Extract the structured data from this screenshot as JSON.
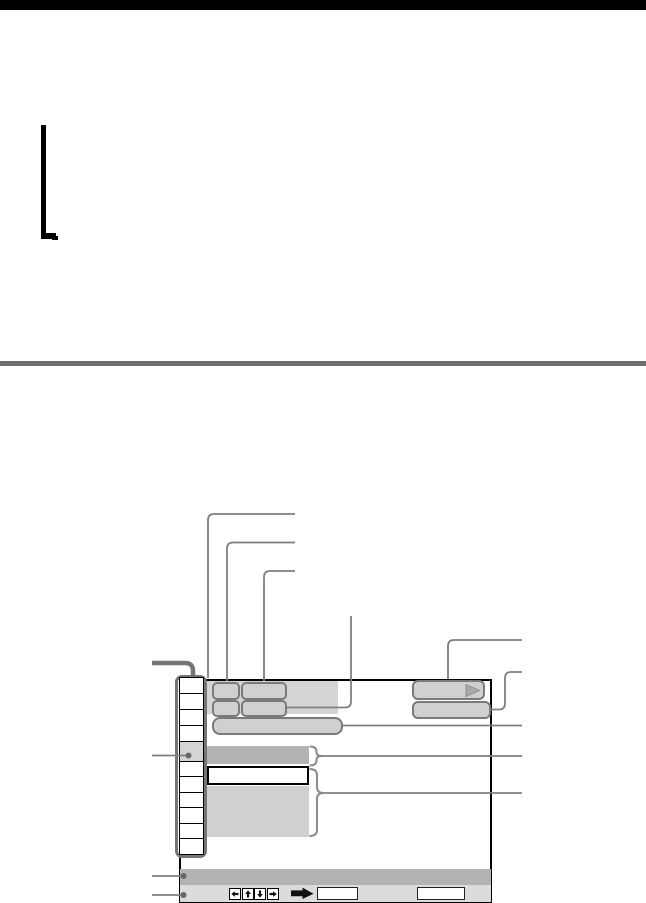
{
  "palette": {
    "top_rule": "#000000",
    "divider": "#6e6e6e",
    "callout_line": "#7f7f7f",
    "thick_leader": "#757575",
    "panel_gray": "#d4d4d4",
    "button_gray": "#d0d0d0",
    "button_border": "#7a7a7a",
    "selected_row_gray": "#b3b3b3",
    "detail_block_gray": "#d0d0d0",
    "bottom_bar_dark": "#b3b3b3",
    "bottom_bar_light": "#dcdcdc",
    "play_triangle": "#a9a9a9",
    "callout_dot": "#686868",
    "screen_border": "#000000"
  },
  "diagram": {
    "index_column_cells": 11,
    "highlighted_cell_index": 5,
    "callout_dots": 3,
    "top_callout_lines": 4,
    "right_callout_lines": 5,
    "left_callout_lines": 4,
    "icons": [
      "play-icon",
      "left-arrow-icon",
      "up-arrow-icon",
      "down-arrow-icon",
      "right-arrow-icon",
      "bold-right-arrow-icon"
    ]
  }
}
